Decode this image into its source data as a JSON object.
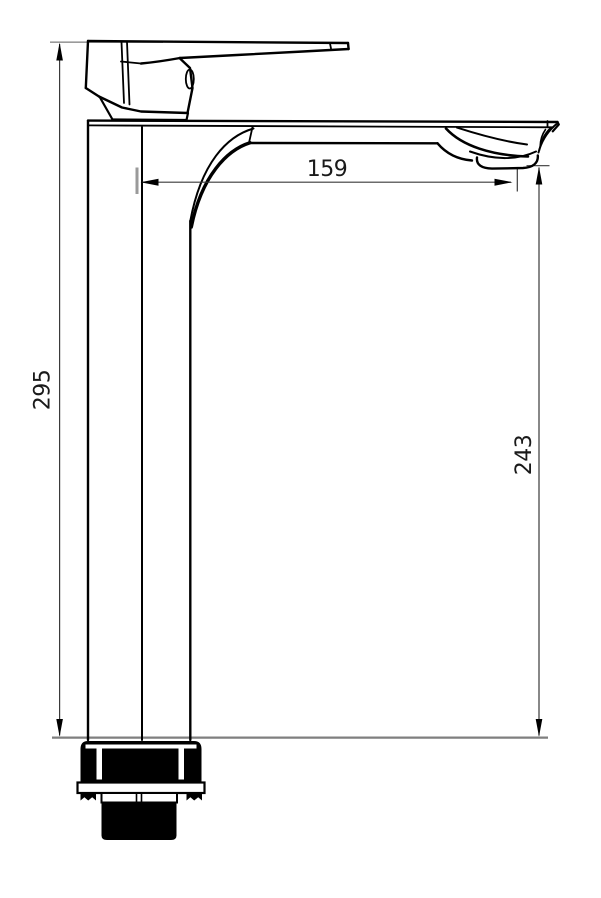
{
  "title": "Tall single-lever basin mixer faucet — dimensional technical drawing, side view",
  "background": "#ffffff",
  "colors": {
    "outline": "#000000",
    "dimension_line": "#3a3a3a",
    "extension_line": "#9a9a9a",
    "ground_line": "#7f7f7f",
    "text": "#1a1a1a"
  },
  "dimensions": {
    "overall_height": {
      "value": "295",
      "orientation": "vertical",
      "position": "left"
    },
    "spout_reach": {
      "value": "159",
      "orientation": "horizontal",
      "position": "top"
    },
    "spout_height": {
      "value": "243",
      "orientation": "vertical",
      "position": "right"
    }
  },
  "parts": [
    "lever-handle",
    "handle-escutcheon",
    "body-column",
    "spout-arm",
    "aerator-outlet",
    "mounting-gasket",
    "mounting-flange",
    "threaded-shank"
  ]
}
